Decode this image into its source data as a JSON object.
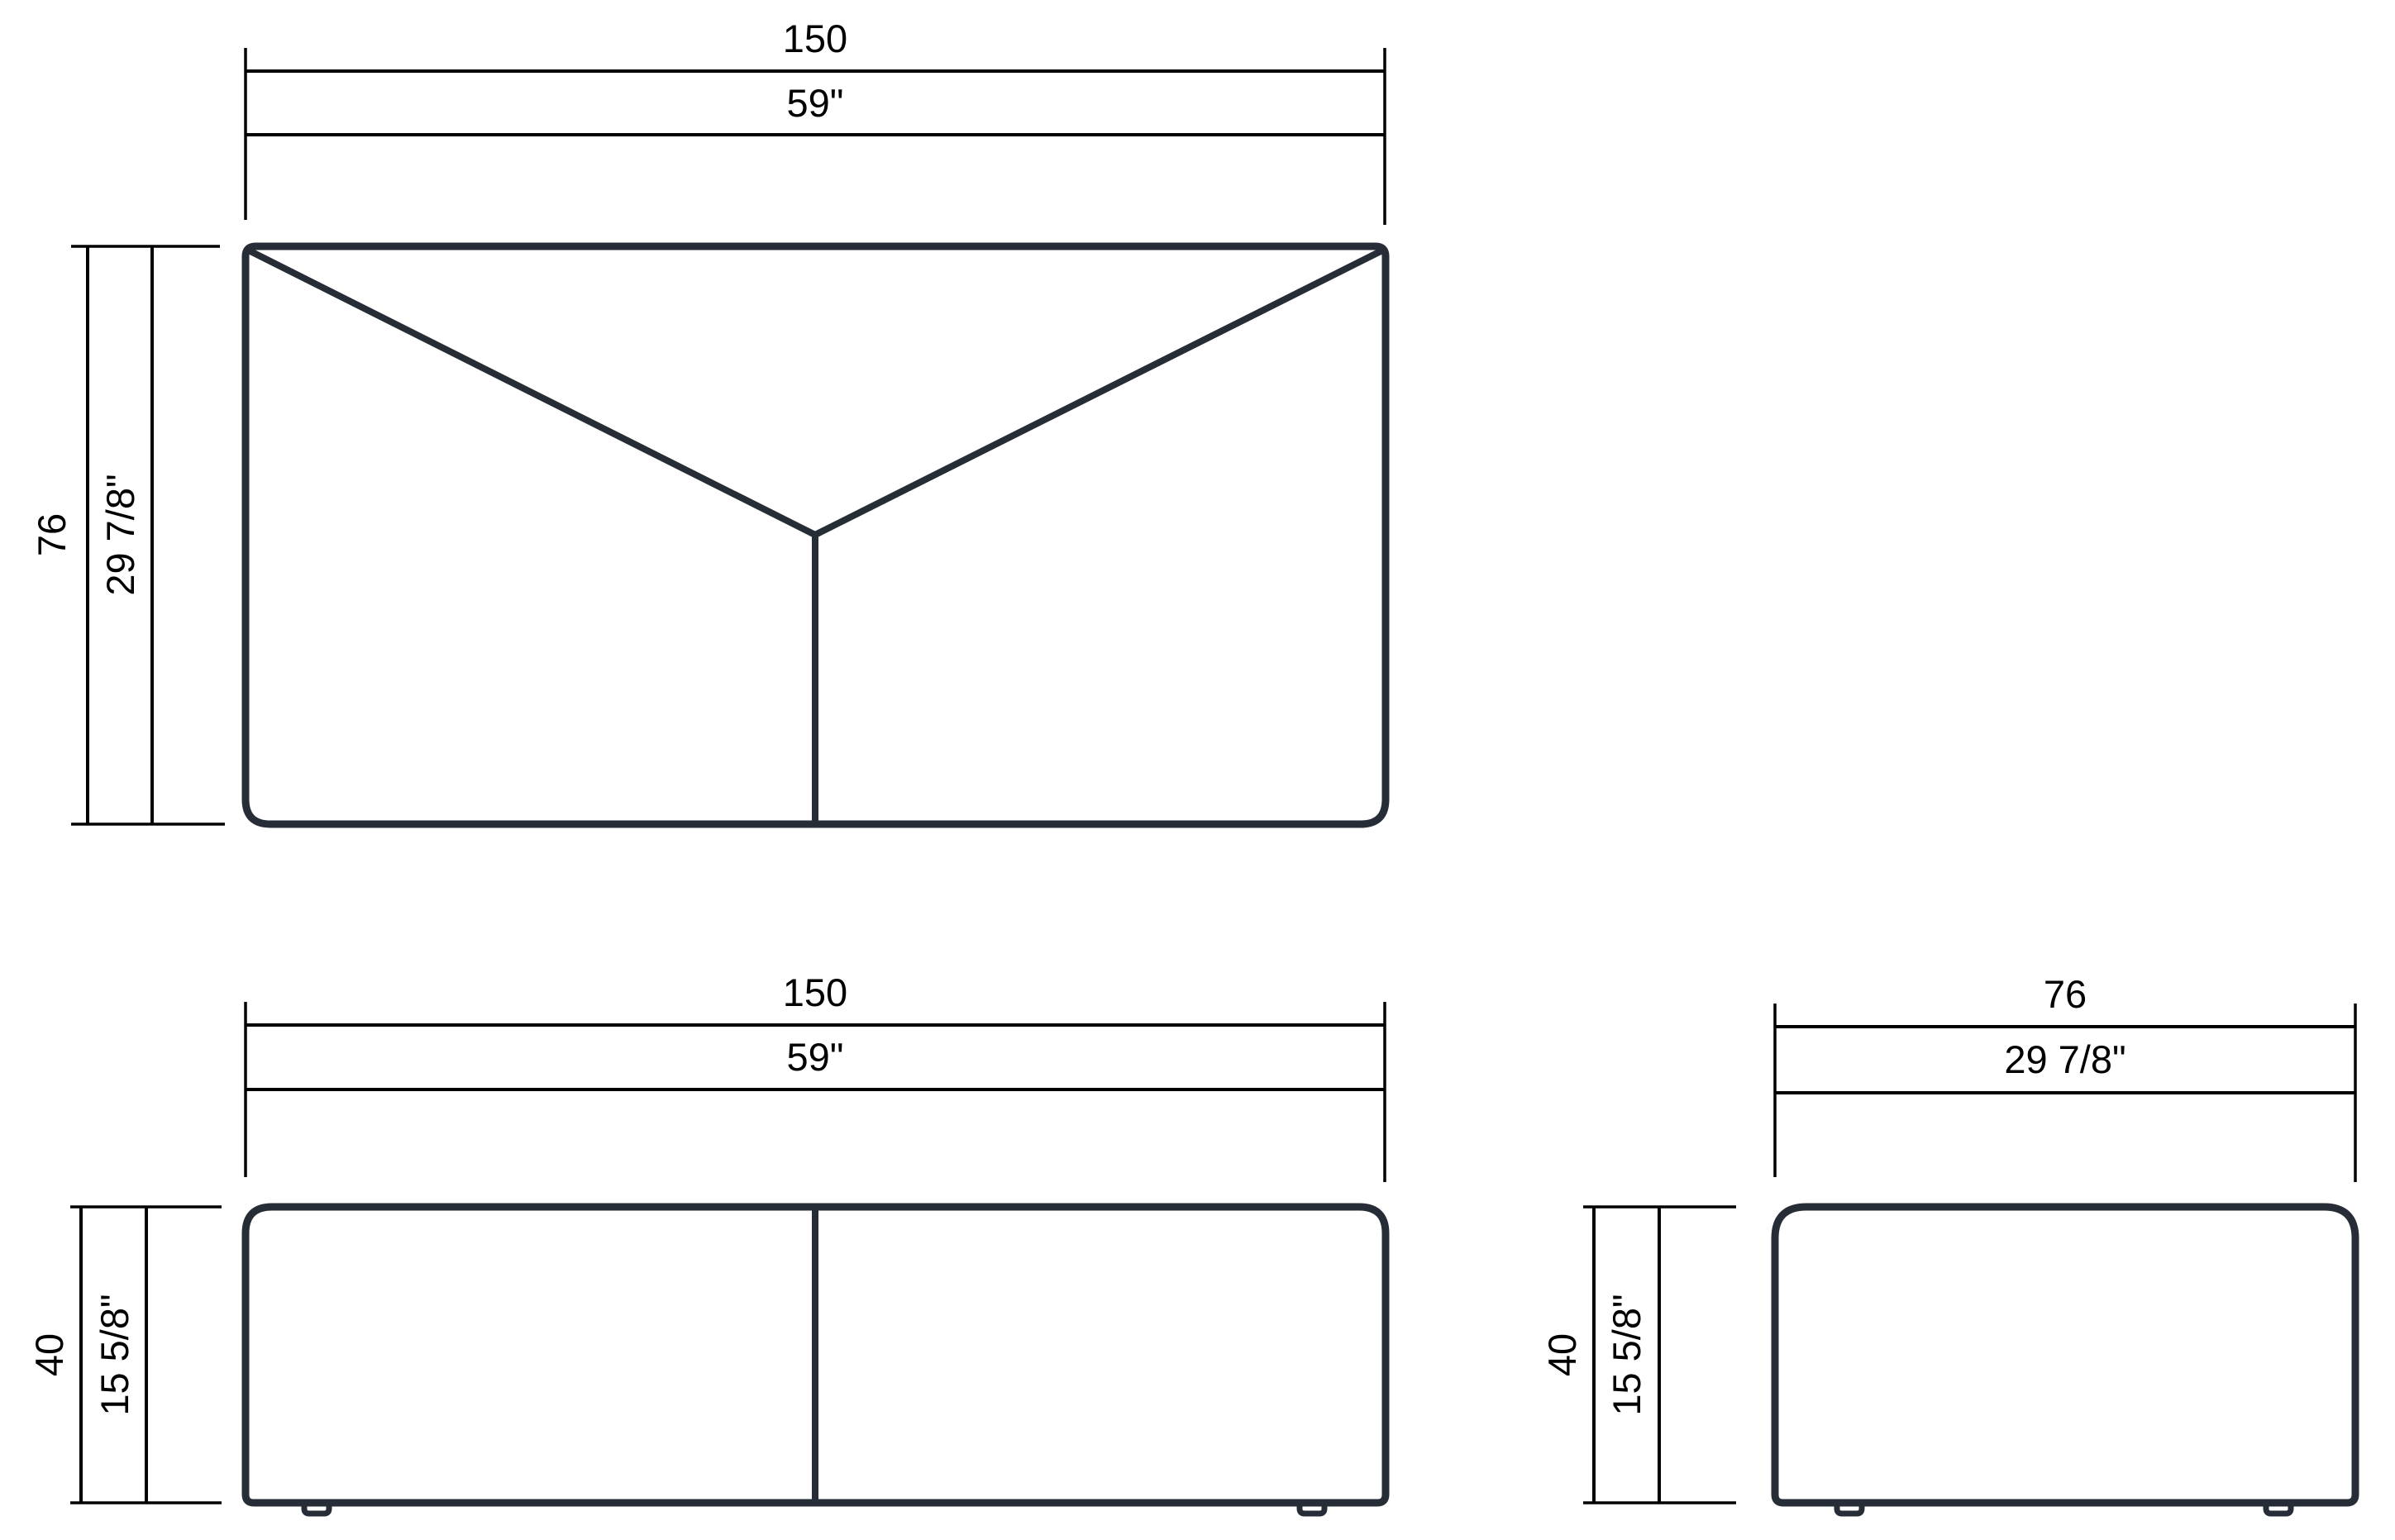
{
  "drawing": {
    "kind": "furniture-dimension-diagram",
    "colors": {
      "background": "#ffffff",
      "object_outline": "#272d36",
      "dimension_lines": "#000000",
      "text": "#000000"
    }
  },
  "dimensions": {
    "top_width": {
      "metric": "150",
      "imperial": "59\""
    },
    "top_depth": {
      "metric": "76",
      "imperial": "29 7/8\""
    },
    "front_width": {
      "metric": "150",
      "imperial": "59\""
    },
    "front_height": {
      "metric": "40",
      "imperial": "15 5/8\""
    },
    "side_width": {
      "metric": "76",
      "imperial": "29 7/8\""
    },
    "side_height": {
      "metric": "40",
      "imperial": "15 5/8\""
    }
  }
}
